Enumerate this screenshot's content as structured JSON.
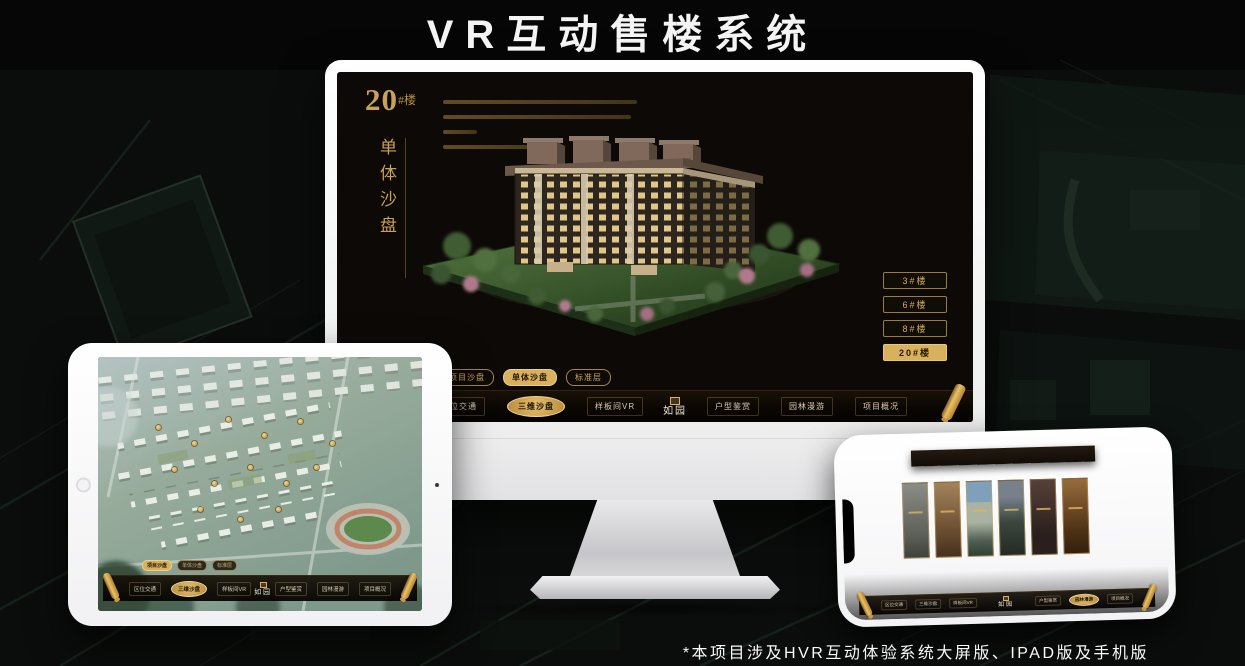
{
  "page": {
    "title": "VR互动售楼系统",
    "footnote": "*本项目涉及HVR互动体验系统大屏版、IPAD版及手机版"
  },
  "colors": {
    "gold": "#d9b05c",
    "gold_bright": "#e8c87a",
    "screen_bg": "#0c0906",
    "nav_text": "#d8cbae"
  },
  "monitor": {
    "hero": {
      "number": "20",
      "suffix": "#楼",
      "subtitle": "单体沙盘"
    },
    "floor_buttons": [
      {
        "label": "3#楼"
      },
      {
        "label": "6#楼"
      },
      {
        "label": "8#楼"
      },
      {
        "label": "20#楼",
        "active": true
      }
    ],
    "sub_tabs": [
      {
        "label": "项目沙盘"
      },
      {
        "label": "单体沙盘",
        "active": true
      },
      {
        "label": "标准层"
      }
    ],
    "nav_left": [
      {
        "label": "区位交通"
      },
      {
        "label": "三维沙盘",
        "active": true
      },
      {
        "label": "样板间VR"
      }
    ],
    "nav_right": [
      {
        "label": "户型鉴赏"
      },
      {
        "label": "园林漫游"
      },
      {
        "label": "项目概况"
      }
    ],
    "logo": "如园"
  },
  "tablet": {
    "sub_tabs": [
      {
        "label": "项目沙盘",
        "active": true
      },
      {
        "label": "单体沙盘"
      },
      {
        "label": "标准层"
      }
    ],
    "nav_left": [
      {
        "label": "区位交通"
      },
      {
        "label": "三维沙盘",
        "active": true
      },
      {
        "label": "样板间VR"
      }
    ],
    "nav_right": [
      {
        "label": "户型鉴赏"
      },
      {
        "label": "园林漫游"
      },
      {
        "label": "项目概况"
      }
    ],
    "logo": "如园"
  },
  "phone": {
    "nav_left": [
      {
        "label": "区位交通"
      },
      {
        "label": "三维沙盘"
      },
      {
        "label": "样板间VR"
      }
    ],
    "nav_right": [
      {
        "label": "户型鉴赏"
      },
      {
        "label": "园林漫游",
        "active": true
      },
      {
        "label": "项目概况"
      }
    ],
    "logo": "如园"
  }
}
